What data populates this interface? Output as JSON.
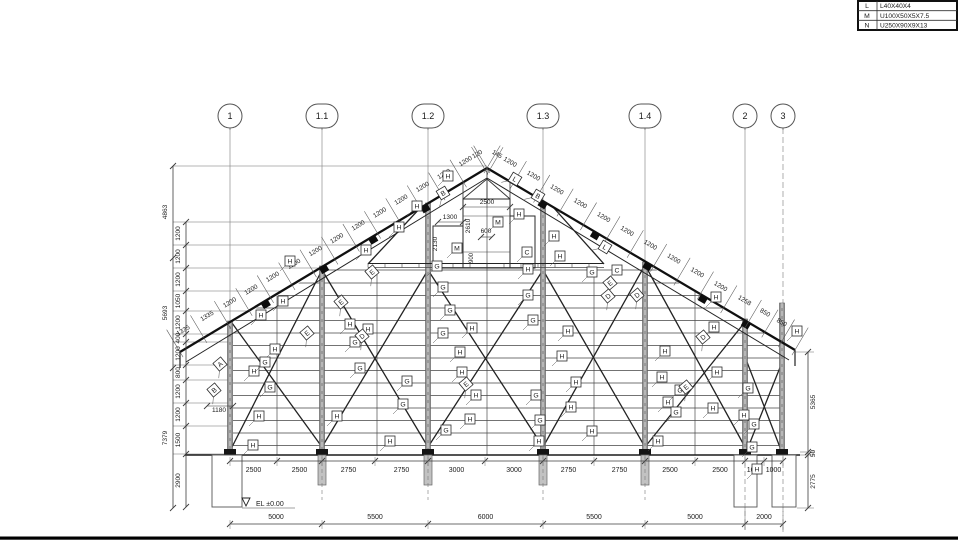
{
  "title": "steel-truss-elevation-drawing",
  "colors": {
    "bg": "#ffffff",
    "line": "#3c3c3c",
    "thin": "#9a9a9a",
    "thick": "#101010",
    "column": "#9a9a9a",
    "text": "#1a1a1a",
    "frame": "#000000"
  },
  "legend": {
    "rows": [
      {
        "key": "L",
        "value": "L40X40X4"
      },
      {
        "key": "M",
        "value": "U100X50X5X7.5"
      },
      {
        "key": "N",
        "value": "U250X90X9X13"
      }
    ]
  },
  "grid": {
    "bubble_y": 116,
    "items": [
      {
        "label": "1",
        "x": 230,
        "shape": "circle"
      },
      {
        "label": "1.1",
        "x": 322,
        "shape": "stadium"
      },
      {
        "label": "1.2",
        "x": 428,
        "shape": "stadium"
      },
      {
        "label": "1.3",
        "x": 543,
        "shape": "stadium"
      },
      {
        "label": "1.4",
        "x": 645,
        "shape": "stadium"
      },
      {
        "label": "2",
        "x": 745,
        "shape": "circle"
      },
      {
        "label": "3",
        "x": 783,
        "shape": "circle"
      }
    ]
  },
  "geometry": {
    "apex": {
      "x": 487,
      "y": 168
    },
    "eave_left": {
      "x": 180,
      "y": 352
    },
    "eave_right": {
      "x": 795,
      "y": 350
    },
    "base_y": 455,
    "ground_x1": 185,
    "ground_x2": 800,
    "girt_ys": [
      270,
      283,
      295.5,
      308,
      320.5,
      333,
      345.5,
      358,
      370.5,
      383,
      395.5,
      408,
      420.5,
      433,
      445.5
    ],
    "clip_poly": "233,455 233,322 487,172 781,342 781,455",
    "columns": [
      [
        230,
        321
      ],
      [
        322,
        266
      ],
      [
        428,
        203
      ],
      [
        543,
        202
      ],
      [
        645,
        262
      ],
      [
        745,
        319
      ],
      [
        782,
        303
      ]
    ],
    "mid_posts": [
      [
        277,
        296
      ],
      [
        377,
        270
      ],
      [
        487,
        178
      ],
      [
        594,
        270
      ],
      [
        695,
        292
      ]
    ],
    "braces": [
      [
        232,
        323,
        322,
        447
      ],
      [
        322,
        270,
        232,
        447
      ],
      [
        322,
        270,
        428,
        447
      ],
      [
        428,
        270,
        322,
        447
      ],
      [
        428,
        270,
        543,
        447
      ],
      [
        543,
        270,
        428,
        447
      ],
      [
        543,
        270,
        645,
        447
      ],
      [
        645,
        265,
        543,
        447
      ],
      [
        645,
        265,
        745,
        447
      ],
      [
        745,
        322,
        645,
        447
      ],
      [
        747,
        362,
        781,
        450
      ],
      [
        781,
        365,
        747,
        450
      ],
      [
        421,
        207,
        368,
        264
      ],
      [
        553,
        207,
        604,
        264
      ]
    ],
    "strut": {
      "x1": 368,
      "x2": 604,
      "y1": 263.5,
      "y2": 267.5
    },
    "chord_blocks_left": [
      0.28,
      0.47,
      0.63,
      0.8
    ],
    "chord_blocks_right": [
      0.18,
      0.35,
      0.52,
      0.7,
      0.84
    ],
    "piles": [
      322,
      428,
      543,
      645
    ],
    "footings": [
      [
        212,
        455,
        30,
        52
      ],
      [
        734,
        455,
        23,
        52
      ],
      [
        772,
        455,
        24,
        52
      ]
    ]
  },
  "slope_labels": {
    "left_from_eave": [
      "1335",
      "1335",
      "1200",
      "1200",
      "1200",
      "1200",
      "1200",
      "1200",
      "1200",
      "1200",
      "1200",
      "1200",
      "1200",
      "1200",
      "120"
    ],
    "right_from_apex": [
      "145",
      "1200",
      "1200",
      "1200",
      "1200",
      "1200",
      "1200",
      "1200",
      "1200",
      "1200",
      "1200",
      "1258",
      "850",
      "850",
      "700"
    ]
  },
  "monitor": {
    "core": [
      463,
      199,
      47,
      69
    ],
    "left_panel": [
      433,
      226,
      30,
      42
    ],
    "right_panel": [
      510,
      216,
      25,
      52
    ],
    "dims": {
      "w_top": "2500",
      "h_right": "2610",
      "w_left": "1300",
      "h_left": "2130",
      "w_mid": "600",
      "h_mid": "900"
    }
  },
  "dims": {
    "bottom_row1": {
      "y": 461,
      "text_y": 472,
      "ticks": [
        230,
        277,
        322,
        375,
        428,
        485,
        543,
        594,
        645,
        695,
        745,
        764,
        783
      ],
      "values": [
        "2500",
        "2500",
        "2750",
        "2750",
        "3000",
        "3000",
        "2750",
        "2750",
        "2500",
        "2500",
        "1000",
        "1000"
      ]
    },
    "bottom_row2": {
      "y": 524,
      "text_y": 519,
      "ticks": [
        230,
        322,
        428,
        543,
        645,
        745,
        783
      ],
      "values": [
        "5000",
        "5500",
        "6000",
        "5500",
        "5000",
        "2000"
      ]
    },
    "left_outer": {
      "x": 173,
      "ticks": [
        166,
        258,
        368,
        508
      ],
      "values": [
        "4863",
        "5693",
        "7379"
      ]
    },
    "left_inner": {
      "x": 186,
      "ticks": [
        222,
        245,
        268,
        291,
        311,
        334,
        342,
        365,
        380,
        403,
        426,
        454,
        507
      ],
      "values": [
        "1200",
        "1200",
        "1200",
        "1050",
        "1200",
        "400",
        "1200",
        "800",
        "1200",
        "1200",
        "1500",
        "2900"
      ]
    },
    "right_chain": {
      "x": 808,
      "ticks": [
        352,
        452,
        455,
        508
      ],
      "values": [
        "5365",
        "50",
        "2775"
      ]
    },
    "dim_1180": {
      "text": "1180",
      "x": 219,
      "y": 412
    },
    "left_ext": [
      [
        166,
        487
      ],
      [
        222,
        397
      ],
      [
        245,
        358
      ],
      [
        268,
        320
      ],
      [
        291,
        282
      ],
      [
        311,
        249
      ],
      [
        334,
        233
      ],
      [
        342,
        233
      ],
      [
        365,
        233
      ],
      [
        380,
        233
      ],
      [
        403,
        233
      ],
      [
        426,
        233
      ],
      [
        454,
        233
      ]
    ],
    "right_ext": [
      [
        352,
        795,
        814
      ],
      [
        452,
        800,
        814
      ],
      [
        455,
        786,
        814
      ],
      [
        508,
        797,
        814
      ]
    ]
  },
  "elevation": {
    "text": "EL  ±0.00"
  },
  "tags": [
    {
      "t": "H",
      "x": 448,
      "y": 176
    },
    {
      "t": "H",
      "x": 417,
      "y": 206
    },
    {
      "t": "H",
      "x": 399,
      "y": 227
    },
    {
      "t": "H",
      "x": 366,
      "y": 250
    },
    {
      "t": "H",
      "x": 290,
      "y": 261
    },
    {
      "t": "H",
      "x": 519,
      "y": 214
    },
    {
      "t": "H",
      "x": 554,
      "y": 236
    },
    {
      "t": "H",
      "x": 560,
      "y": 256
    },
    {
      "t": "H",
      "x": 528,
      "y": 269
    },
    {
      "t": "H",
      "x": 283,
      "y": 301
    },
    {
      "t": "H",
      "x": 261,
      "y": 315
    },
    {
      "t": "H",
      "x": 350,
      "y": 324
    },
    {
      "t": "H",
      "x": 368,
      "y": 329
    },
    {
      "t": "H",
      "x": 472,
      "y": 328
    },
    {
      "t": "H",
      "x": 275,
      "y": 349
    },
    {
      "t": "H",
      "x": 460,
      "y": 352
    },
    {
      "t": "H",
      "x": 568,
      "y": 331
    },
    {
      "t": "H",
      "x": 562,
      "y": 356
    },
    {
      "t": "H",
      "x": 254,
      "y": 371
    },
    {
      "t": "H",
      "x": 462,
      "y": 372
    },
    {
      "t": "H",
      "x": 576,
      "y": 382
    },
    {
      "t": "H",
      "x": 476,
      "y": 395
    },
    {
      "t": "H",
      "x": 571,
      "y": 407
    },
    {
      "t": "H",
      "x": 259,
      "y": 416
    },
    {
      "t": "H",
      "x": 337,
      "y": 416
    },
    {
      "t": "H",
      "x": 470,
      "y": 419
    },
    {
      "t": "H",
      "x": 592,
      "y": 431
    },
    {
      "t": "H",
      "x": 253,
      "y": 445
    },
    {
      "t": "H",
      "x": 390,
      "y": 441
    },
    {
      "t": "H",
      "x": 539,
      "y": 441
    },
    {
      "t": "H",
      "x": 658,
      "y": 441
    },
    {
      "t": "H",
      "x": 665,
      "y": 351
    },
    {
      "t": "H",
      "x": 662,
      "y": 377
    },
    {
      "t": "H",
      "x": 668,
      "y": 402
    },
    {
      "t": "H",
      "x": 716,
      "y": 297
    },
    {
      "t": "H",
      "x": 714,
      "y": 327
    },
    {
      "t": "H",
      "x": 717,
      "y": 372
    },
    {
      "t": "H",
      "x": 713,
      "y": 408
    },
    {
      "t": "H",
      "x": 744,
      "y": 415
    },
    {
      "t": "H",
      "x": 757,
      "y": 469
    },
    {
      "t": "H",
      "x": 797,
      "y": 331
    },
    {
      "t": "G",
      "x": 443,
      "y": 287
    },
    {
      "t": "G",
      "x": 450,
      "y": 310
    },
    {
      "t": "G",
      "x": 443,
      "y": 333
    },
    {
      "t": "G",
      "x": 265,
      "y": 362
    },
    {
      "t": "G",
      "x": 270,
      "y": 387
    },
    {
      "t": "G",
      "x": 355,
      "y": 342
    },
    {
      "t": "G",
      "x": 360,
      "y": 368
    },
    {
      "t": "G",
      "x": 407,
      "y": 381
    },
    {
      "t": "G",
      "x": 403,
      "y": 404
    },
    {
      "t": "G",
      "x": 446,
      "y": 430
    },
    {
      "t": "G",
      "x": 528,
      "y": 295
    },
    {
      "t": "G",
      "x": 533,
      "y": 320
    },
    {
      "t": "G",
      "x": 536,
      "y": 395
    },
    {
      "t": "G",
      "x": 540,
      "y": 420
    },
    {
      "t": "G",
      "x": 680,
      "y": 390
    },
    {
      "t": "G",
      "x": 676,
      "y": 412
    },
    {
      "t": "G",
      "x": 748,
      "y": 388
    },
    {
      "t": "G",
      "x": 754,
      "y": 424
    },
    {
      "t": "G",
      "x": 752,
      "y": 447
    },
    {
      "t": "G",
      "x": 592,
      "y": 272
    },
    {
      "t": "G",
      "x": 437,
      "y": 266
    },
    {
      "t": "E",
      "x": 307,
      "y": 333,
      "r": -40
    },
    {
      "t": "E",
      "x": 341,
      "y": 302,
      "r": -40
    },
    {
      "t": "E",
      "x": 610,
      "y": 283,
      "r": -40
    },
    {
      "t": "E",
      "x": 686,
      "y": 387,
      "r": -40
    },
    {
      "t": "E",
      "x": 466,
      "y": 384,
      "r": -40
    },
    {
      "t": "E",
      "x": 372,
      "y": 272,
      "r": -40
    },
    {
      "t": "D",
      "x": 362,
      "y": 336,
      "r": -40
    },
    {
      "t": "D",
      "x": 608,
      "y": 296,
      "r": -40
    },
    {
      "t": "D",
      "x": 637,
      "y": 295,
      "r": -40
    },
    {
      "t": "D",
      "x": 703,
      "y": 337,
      "r": -40
    },
    {
      "t": "C",
      "x": 527,
      "y": 252
    },
    {
      "t": "C",
      "x": 617,
      "y": 270
    },
    {
      "t": "M",
      "x": 498,
      "y": 222
    },
    {
      "t": "M",
      "x": 457,
      "y": 248
    },
    {
      "t": "L",
      "x": 515,
      "y": 179,
      "r": 31
    },
    {
      "t": "L",
      "x": 605,
      "y": 247,
      "r": 31
    },
    {
      "t": "B",
      "x": 538,
      "y": 196,
      "r": 31
    },
    {
      "t": "B",
      "x": 443,
      "y": 193,
      "r": -31
    },
    {
      "t": "B",
      "x": 214,
      "y": 390,
      "r": -40
    },
    {
      "t": "A",
      "x": 220,
      "y": 364,
      "r": -40
    }
  ]
}
